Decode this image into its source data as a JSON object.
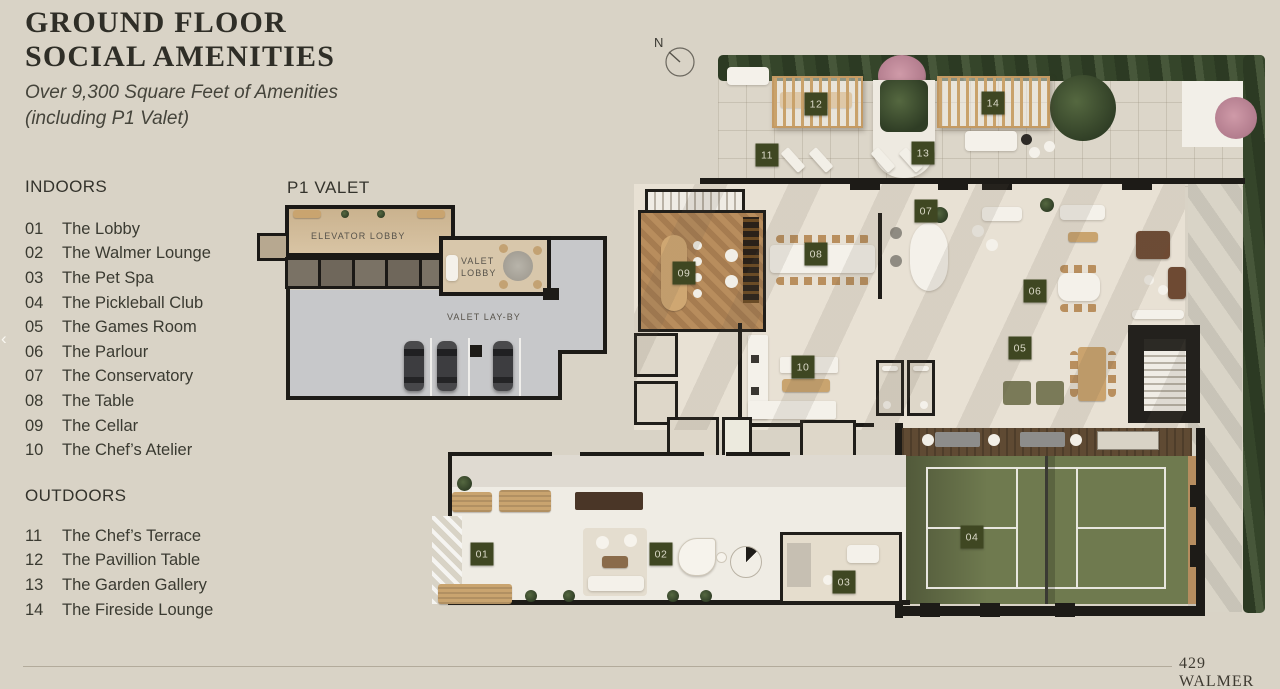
{
  "header": {
    "title_line1": "GROUND FLOOR",
    "title_line2": "SOCIAL AMENITIES",
    "subtitle_line1": "Over 9,300 Square Feet of Amenities",
    "subtitle_line2": "(including P1 Valet)"
  },
  "legend": {
    "indoors": {
      "heading": "INDOORS",
      "items": [
        {
          "num": "01",
          "label": "The Lobby"
        },
        {
          "num": "02",
          "label": "The Walmer Lounge"
        },
        {
          "num": "03",
          "label": "The Pet Spa"
        },
        {
          "num": "04",
          "label": "The Pickleball Club"
        },
        {
          "num": "05",
          "label": "The Games Room"
        },
        {
          "num": "06",
          "label": "The Parlour"
        },
        {
          "num": "07",
          "label": "The Conservatory"
        },
        {
          "num": "08",
          "label": "The Table"
        },
        {
          "num": "09",
          "label": "The Cellar"
        },
        {
          "num": "10",
          "label": "The Chef’s Atelier"
        }
      ]
    },
    "outdoors": {
      "heading": "OUTDOORS",
      "items": [
        {
          "num": "11",
          "label": "The Chef’s Terrace"
        },
        {
          "num": "12",
          "label": "The Pavillion Table"
        },
        {
          "num": "13",
          "label": "The Garden Gallery"
        },
        {
          "num": "14",
          "label": "The Fireside Lounge"
        }
      ]
    }
  },
  "valet": {
    "heading": "P1 VALET",
    "rooms": {
      "elevator_lobby": "ELEVATOR LOBBY",
      "valet_lobby": "VALET LOBBY",
      "valet_layby": "VALET LAY-BY"
    }
  },
  "plan": {
    "compass_label": "N",
    "badges": [
      {
        "num": "01",
        "x": 482,
        "y": 554
      },
      {
        "num": "02",
        "x": 661,
        "y": 554
      },
      {
        "num": "03",
        "x": 844,
        "y": 582
      },
      {
        "num": "04",
        "x": 972,
        "y": 537
      },
      {
        "num": "05",
        "x": 1020,
        "y": 348
      },
      {
        "num": "06",
        "x": 1035,
        "y": 291
      },
      {
        "num": "07",
        "x": 926,
        "y": 211
      },
      {
        "num": "08",
        "x": 816,
        "y": 254
      },
      {
        "num": "09",
        "x": 684,
        "y": 273
      },
      {
        "num": "10",
        "x": 803,
        "y": 367
      },
      {
        "num": "11",
        "x": 767,
        "y": 155
      },
      {
        "num": "12",
        "x": 816,
        "y": 104
      },
      {
        "num": "13",
        "x": 923,
        "y": 153
      },
      {
        "num": "14",
        "x": 993,
        "y": 103
      }
    ]
  },
  "nav": {
    "prev_arrow": "‹"
  },
  "footer": {
    "project_name": "429 WALMER"
  },
  "colors": {
    "background": "#d9d3c6",
    "wall": "#1d1b17",
    "badge_bg": "#3f4722",
    "badge_text": "#dbd9c8",
    "court_green": "#6f7a4f"
  }
}
